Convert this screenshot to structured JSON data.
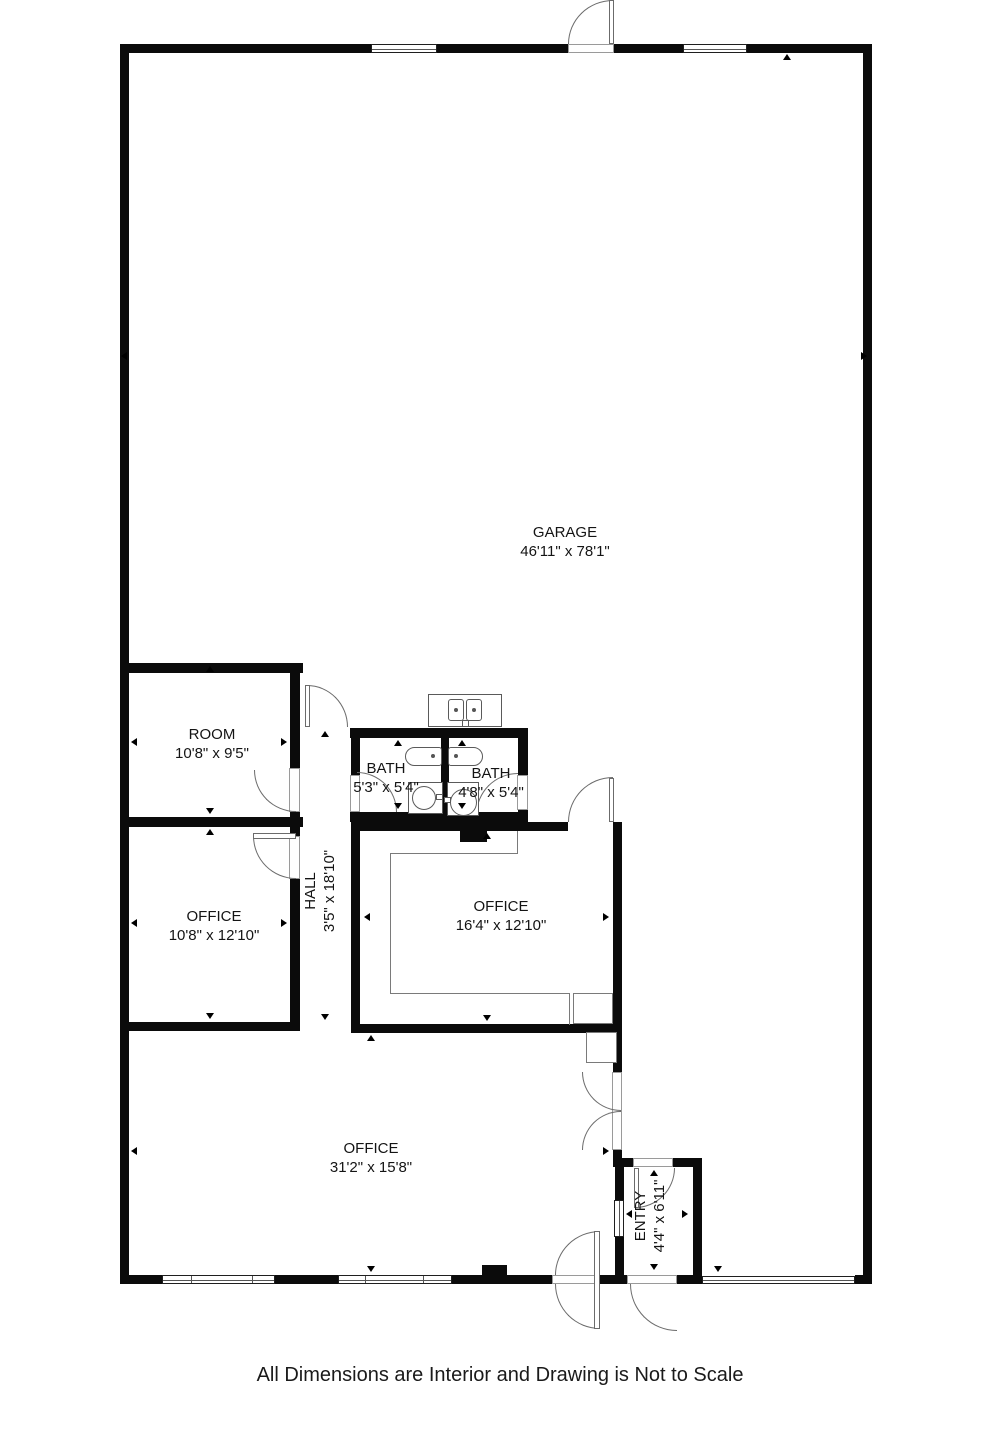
{
  "plan": {
    "caption": "All Dimensions are Interior and Drawing is Not to Scale",
    "rooms": [
      {
        "name": "GARAGE",
        "dims": "46'11\" x 78'1\""
      },
      {
        "name": "ROOM",
        "dims": "10'8\" x 9'5\""
      },
      {
        "name": "OFFICE",
        "dims": "10'8\" x 12'10\""
      },
      {
        "name": "HALL",
        "dims": "3'5\" x 18'10\""
      },
      {
        "name": "BATH",
        "dims": "5'3\" x 5'4\""
      },
      {
        "name": "BATH",
        "dims": "4'8\" x 5'4\""
      },
      {
        "name": "OFFICE",
        "dims": "16'4\" x 12'10\""
      },
      {
        "name": "OFFICE",
        "dims": "31'2\" x 15'8\""
      },
      {
        "name": "ENTRY",
        "dims": "4'4\" x 6'11\""
      }
    ],
    "colors": {
      "wall": "#0b0b0b",
      "thin_line": "#6b6b6b",
      "background": "#ffffff",
      "text": "#141414"
    }
  }
}
